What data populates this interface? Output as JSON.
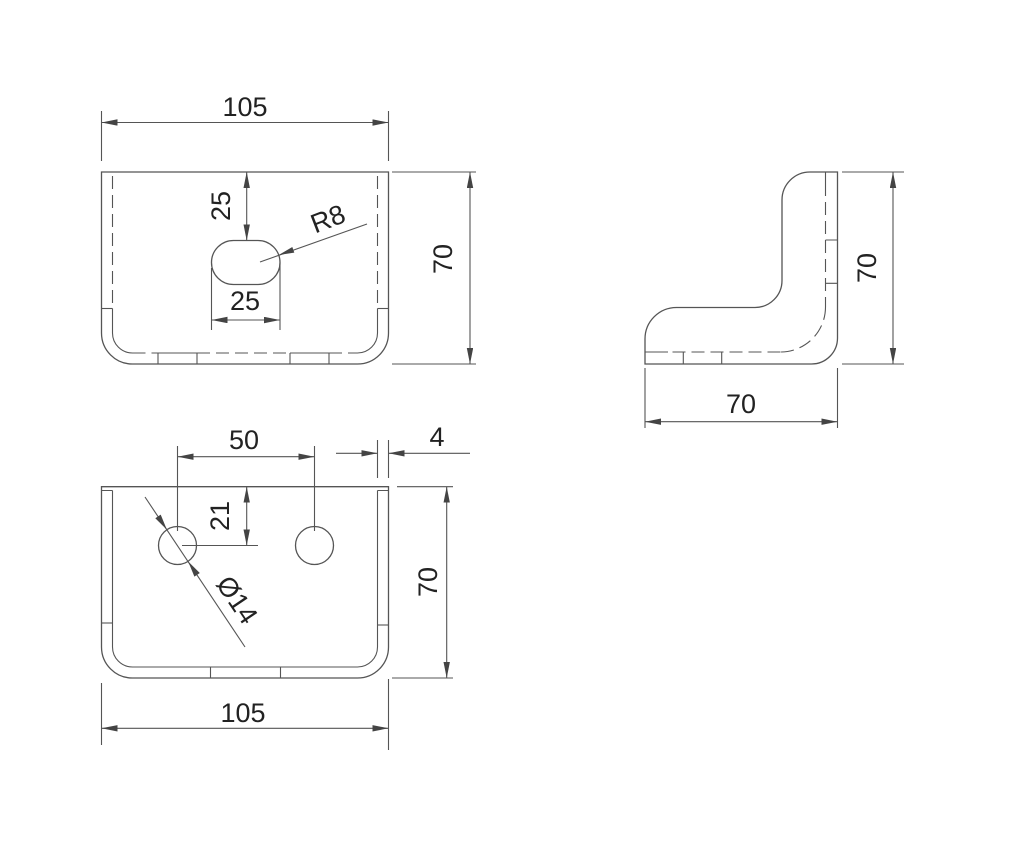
{
  "document": {
    "type": "technical-drawing",
    "part": "sheet-metal-angle-bracket"
  },
  "colors": {
    "background": "#ffffff",
    "line": "#555555",
    "text": "#222222"
  },
  "views": {
    "top": {
      "label": "top-view",
      "dimensions": {
        "width": "105",
        "depth": "70",
        "slot_offset_from_edge": "25",
        "slot_length": "25",
        "slot_end_radius": "R8"
      }
    },
    "front": {
      "label": "front-view",
      "dimensions": {
        "hole_spacing": "50",
        "material_thickness": "4",
        "hole_offset_from_top": "21",
        "height": "70",
        "width": "105",
        "hole_diameter": "Ø14"
      }
    },
    "side": {
      "label": "side-view",
      "dimensions": {
        "height": "70",
        "depth": "70"
      }
    }
  }
}
